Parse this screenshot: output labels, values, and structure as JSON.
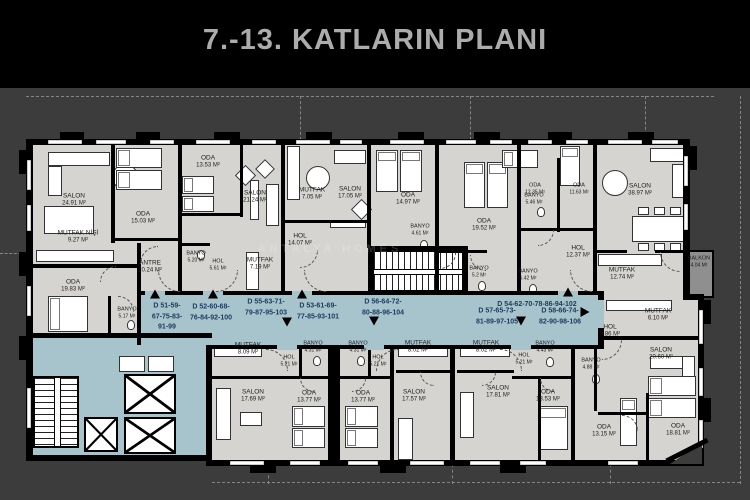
{
  "title": "7.-13. KATLARIN PLANI",
  "watermark": "ANTALYA HOMES",
  "colors": {
    "background": "#3c3c3c",
    "header": "#000000",
    "title_text": "#acacac",
    "floor": "#d6d4d0",
    "corridor": "#a7c3cc",
    "wall": "#000000",
    "apartment_label": "#1a3a5c"
  },
  "rooms": [
    {
      "name": "SALON",
      "area": "24.91 M²",
      "x": 74,
      "y": 200
    },
    {
      "name": "MUTFAK NİŞİ",
      "area": "9.27 M²",
      "x": 78,
      "y": 237
    },
    {
      "name": "ODA",
      "area": "19.83 M²",
      "x": 73,
      "y": 286
    },
    {
      "name": "ODA",
      "area": "15.03 M²",
      "x": 143,
      "y": 218
    },
    {
      "name": "ANTRE",
      "area": "10.24 M²",
      "x": 150,
      "y": 267
    },
    {
      "name": "BANYO",
      "area": "5.17 M²",
      "x": 127,
      "y": 313,
      "small": true
    },
    {
      "name": "ODA",
      "area": "13.53 M²",
      "x": 208,
      "y": 162
    },
    {
      "name": "SALON",
      "area": "21.24 M²",
      "x": 255,
      "y": 197
    },
    {
      "name": "BANYO",
      "area": "5.20 M²",
      "x": 196,
      "y": 257,
      "small": true
    },
    {
      "name": "HOL",
      "area": "5.61 M²",
      "x": 218,
      "y": 265,
      "small": true
    },
    {
      "name": "MUTFAK",
      "area": "7.19 M²",
      "x": 260,
      "y": 264
    },
    {
      "name": "MUTFAK",
      "area": "7.05 M²",
      "x": 312,
      "y": 194
    },
    {
      "name": "SALON",
      "area": "17.05 M²",
      "x": 350,
      "y": 193
    },
    {
      "name": "HOL",
      "area": "14.07 M²",
      "x": 300,
      "y": 240
    },
    {
      "name": "ODA",
      "area": "14.97 M²",
      "x": 408,
      "y": 199
    },
    {
      "name": "BANYO",
      "area": "4.61 M²",
      "x": 420,
      "y": 230,
      "small": true
    },
    {
      "name": "ODA",
      "area": "19.52 M²",
      "x": 484,
      "y": 225
    },
    {
      "name": "BANYO",
      "area": "5.2 M²",
      "x": 479,
      "y": 272,
      "small": true
    },
    {
      "name": "BANYO",
      "area": "6.42 M²",
      "x": 528,
      "y": 275,
      "small": true
    },
    {
      "name": "ODA",
      "area": "12.35 M²",
      "x": 535,
      "y": 189,
      "small": true
    },
    {
      "name": "BANYO",
      "area": "5.46 M²",
      "x": 534,
      "y": 199,
      "small": true
    },
    {
      "name": "ODA",
      "area": "11.63 M²",
      "x": 579,
      "y": 189,
      "small": true
    },
    {
      "name": "HOL",
      "area": "12.37 M²",
      "x": 578,
      "y": 252
    },
    {
      "name": "MUTFAK",
      "area": "12.74 M²",
      "x": 622,
      "y": 274
    },
    {
      "name": "SALON",
      "area": "38.97 M²",
      "x": 640,
      "y": 190
    },
    {
      "name": "BALKON",
      "area": "4.04 M²",
      "x": 699,
      "y": 262,
      "small": true
    },
    {
      "name": "MUTFAK",
      "area": "6.10 M²",
      "x": 658,
      "y": 315
    },
    {
      "name": "HOL",
      "area": "9.86 M²",
      "x": 610,
      "y": 331
    },
    {
      "name": "SALON",
      "area": "20.60 M²",
      "x": 661,
      "y": 354
    },
    {
      "name": "BANYO",
      "area": "4.88 M²",
      "x": 591,
      "y": 364,
      "small": true
    },
    {
      "name": "ODA",
      "area": "13.15 M²",
      "x": 604,
      "y": 431
    },
    {
      "name": "ODA",
      "area": "18.81 M²",
      "x": 678,
      "y": 430
    },
    {
      "name": "MUTFAK",
      "area": "8.09 M²",
      "x": 248,
      "y": 349
    },
    {
      "name": "HOL",
      "area": "5.21 M²",
      "x": 289,
      "y": 361,
      "small": true
    },
    {
      "name": "BANYO",
      "area": "4.31 M²",
      "x": 313,
      "y": 347,
      "small": true
    },
    {
      "name": "BANYO",
      "area": "4.31 M²",
      "x": 358,
      "y": 347,
      "small": true
    },
    {
      "name": "HOL",
      "area": "5.21 M²",
      "x": 378,
      "y": 361,
      "small": true
    },
    {
      "name": "SALON",
      "area": "17.69 M²",
      "x": 253,
      "y": 396
    },
    {
      "name": "ODA",
      "area": "13.77 M²",
      "x": 309,
      "y": 397
    },
    {
      "name": "ODA",
      "area": "13.77 M²",
      "x": 363,
      "y": 397
    },
    {
      "name": "MUTFAK",
      "area": "8.02 M²",
      "x": 418,
      "y": 347
    },
    {
      "name": "MUTFAK",
      "area": "8.02 M²",
      "x": 486,
      "y": 347
    },
    {
      "name": "HOL",
      "area": "5.21 M²",
      "x": 524,
      "y": 359,
      "small": true
    },
    {
      "name": "BANYO",
      "area": "4.43 M²",
      "x": 545,
      "y": 347,
      "small": true
    },
    {
      "name": "SALON",
      "area": "17.57 M²",
      "x": 414,
      "y": 396
    },
    {
      "name": "SALON",
      "area": "17.81 M²",
      "x": 498,
      "y": 392
    },
    {
      "name": "ODA",
      "area": "13.53 M²",
      "x": 548,
      "y": 396
    }
  ],
  "apartments": [
    {
      "lines": [
        "D 51-59-",
        "67-75-83-",
        "91-99"
      ],
      "x": 167,
      "y": 317,
      "arrow": "up",
      "ax": 155,
      "ay": 294
    },
    {
      "lines": [
        "D 52-60-68-",
        "76-84-92-100"
      ],
      "x": 211,
      "y": 313,
      "arrow": "up",
      "ax": 213,
      "ay": 294
    },
    {
      "lines": [
        "D 55-63-71-",
        "79-87-95-103"
      ],
      "x": 266,
      "y": 308,
      "arrow": "down",
      "ax": 287,
      "ay": 322
    },
    {
      "lines": [
        "D 53-61-69-",
        "77-85-93-101"
      ],
      "x": 318,
      "y": 312,
      "arrow": "up",
      "ax": 302,
      "ay": 294
    },
    {
      "lines": [
        "D 56-64-72-",
        "80-88-96-104"
      ],
      "x": 383,
      "y": 308,
      "arrow": "down",
      "ax": 374,
      "ay": 321
    },
    {
      "lines": [
        "D 54-62-70-78-86-94-102"
      ],
      "x": 537,
      "y": 305,
      "arrow": "up",
      "ax": 568,
      "ay": 292
    },
    {
      "lines": [
        "D 57-65-73-",
        "81-89-97-105"
      ],
      "x": 497,
      "y": 317,
      "arrow": "down",
      "ax": 521,
      "ay": 321
    },
    {
      "lines": [
        "D 58-66-74-",
        "82-90-98-106"
      ],
      "x": 560,
      "y": 317,
      "arrow": "right",
      "ax": 585,
      "ay": 312
    }
  ]
}
